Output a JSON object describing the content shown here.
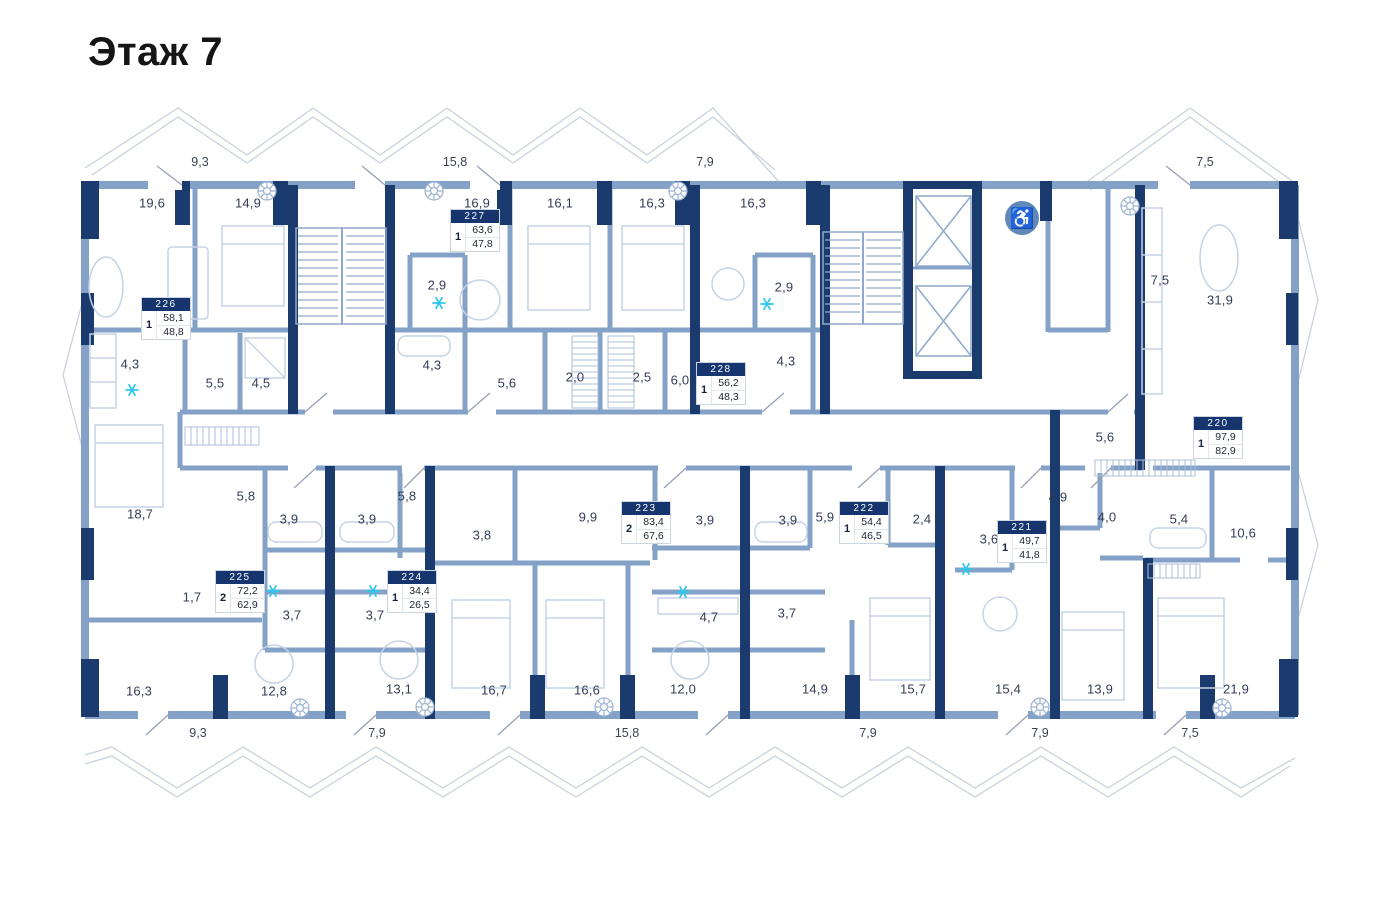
{
  "title": "Этаж 7",
  "colors": {
    "wall_dark": "#1b3a6e",
    "wall_light": "#84a1c7",
    "furniture": "#c5d3e5",
    "accent_snowflake": "#2ec6ea",
    "accessibility_bg": "#6089ba",
    "apartment_header_bg": "#16356e",
    "label_text": "#333d55"
  },
  "icons": {
    "accessibility_glyph": "♿",
    "accessibility_name": "wheelchair-accessibility",
    "snowflake_name": "air-conditioner-snowflake",
    "rosette_name": "ventilation-rosette"
  },
  "floor_plan": {
    "apartments": [
      {
        "number": "226",
        "rooms": "1",
        "area_total": "58,1",
        "area_living": "48,8",
        "x": 142,
        "y": 298
      },
      {
        "number": "227",
        "rooms": "1",
        "area_total": "63,6",
        "area_living": "47,8",
        "x": 451,
        "y": 210
      },
      {
        "number": "228",
        "rooms": "1",
        "area_total": "56,2",
        "area_living": "48,3",
        "x": 697,
        "y": 363
      },
      {
        "number": "220",
        "rooms": "1",
        "area_total": "97,9",
        "area_living": "82,9",
        "x": 1194,
        "y": 417
      },
      {
        "number": "225",
        "rooms": "2",
        "area_total": "72,2",
        "area_living": "62,9",
        "x": 216,
        "y": 571
      },
      {
        "number": "224",
        "rooms": "1",
        "area_total": "34,4",
        "area_living": "26,5",
        "x": 388,
        "y": 571
      },
      {
        "number": "223",
        "rooms": "2",
        "area_total": "83,4",
        "area_living": "67,6",
        "x": 622,
        "y": 502
      },
      {
        "number": "222",
        "rooms": "1",
        "area_total": "54,4",
        "area_living": "46,5",
        "x": 840,
        "y": 502
      },
      {
        "number": "221",
        "rooms": "1",
        "area_total": "49,7",
        "area_living": "41,8",
        "x": 998,
        "y": 521
      }
    ],
    "room_labels": [
      {
        "text": "19,6",
        "x": 152,
        "y": 203
      },
      {
        "text": "14,9",
        "x": 248,
        "y": 203
      },
      {
        "text": "16,9",
        "x": 477,
        "y": 203
      },
      {
        "text": "16,1",
        "x": 560,
        "y": 203
      },
      {
        "text": "16,3",
        "x": 652,
        "y": 203
      },
      {
        "text": "16,3",
        "x": 753,
        "y": 203
      },
      {
        "text": "7,5",
        "x": 1160,
        "y": 280
      },
      {
        "text": "31,9",
        "x": 1220,
        "y": 300
      },
      {
        "text": "2,9",
        "x": 437,
        "y": 285
      },
      {
        "text": "2,9",
        "x": 784,
        "y": 287
      },
      {
        "text": "4,3",
        "x": 130,
        "y": 364
      },
      {
        "text": "5,5",
        "x": 215,
        "y": 383
      },
      {
        "text": "4,5",
        "x": 261,
        "y": 383
      },
      {
        "text": "4,3",
        "x": 432,
        "y": 365
      },
      {
        "text": "5,6",
        "x": 507,
        "y": 383
      },
      {
        "text": "2,0",
        "x": 575,
        "y": 377
      },
      {
        "text": "2,5",
        "x": 642,
        "y": 377
      },
      {
        "text": "6,0",
        "x": 680,
        "y": 380
      },
      {
        "text": "4,3",
        "x": 786,
        "y": 361
      },
      {
        "text": "5,6",
        "x": 1105,
        "y": 437
      },
      {
        "text": "18,7",
        "x": 140,
        "y": 514
      },
      {
        "text": "5,8",
        "x": 246,
        "y": 496
      },
      {
        "text": "3,9",
        "x": 289,
        "y": 519
      },
      {
        "text": "3,9",
        "x": 367,
        "y": 519
      },
      {
        "text": "5,8",
        "x": 407,
        "y": 496
      },
      {
        "text": "3,8",
        "x": 482,
        "y": 535
      },
      {
        "text": "9,9",
        "x": 588,
        "y": 517
      },
      {
        "text": "3,9",
        "x": 705,
        "y": 520
      },
      {
        "text": "3,9",
        "x": 788,
        "y": 520
      },
      {
        "text": "5,9",
        "x": 825,
        "y": 517
      },
      {
        "text": "2,4",
        "x": 922,
        "y": 519
      },
      {
        "text": "3,6",
        "x": 989,
        "y": 539
      },
      {
        "text": "4,9",
        "x": 1058,
        "y": 497
      },
      {
        "text": "4,0",
        "x": 1107,
        "y": 517
      },
      {
        "text": "5,4",
        "x": 1179,
        "y": 519
      },
      {
        "text": "10,6",
        "x": 1243,
        "y": 533
      },
      {
        "text": "1,7",
        "x": 192,
        "y": 597
      },
      {
        "text": "3,7",
        "x": 292,
        "y": 615
      },
      {
        "text": "3,7",
        "x": 375,
        "y": 615
      },
      {
        "text": "4,7",
        "x": 709,
        "y": 617
      },
      {
        "text": "3,7",
        "x": 787,
        "y": 613
      },
      {
        "text": "16,3",
        "x": 139,
        "y": 691
      },
      {
        "text": "12,8",
        "x": 274,
        "y": 691
      },
      {
        "text": "13,1",
        "x": 399,
        "y": 689
      },
      {
        "text": "16,7",
        "x": 494,
        "y": 690
      },
      {
        "text": "16,6",
        "x": 587,
        "y": 690
      },
      {
        "text": "12,0",
        "x": 683,
        "y": 689
      },
      {
        "text": "14,9",
        "x": 815,
        "y": 689
      },
      {
        "text": "15,7",
        "x": 913,
        "y": 689
      },
      {
        "text": "15,4",
        "x": 1008,
        "y": 689
      },
      {
        "text": "13,9",
        "x": 1100,
        "y": 689
      },
      {
        "text": "21,9",
        "x": 1236,
        "y": 689
      }
    ],
    "dimension_labels_top": [
      {
        "text": "9,3",
        "x": 200,
        "y": 162
      },
      {
        "text": "15,8",
        "x": 455,
        "y": 162
      },
      {
        "text": "7,9",
        "x": 705,
        "y": 162
      },
      {
        "text": "7,5",
        "x": 1205,
        "y": 162
      }
    ],
    "dimension_labels_bottom": [
      {
        "text": "9,3",
        "x": 198,
        "y": 733
      },
      {
        "text": "7,9",
        "x": 377,
        "y": 733
      },
      {
        "text": "15,8",
        "x": 627,
        "y": 733
      },
      {
        "text": "7,9",
        "x": 868,
        "y": 733
      },
      {
        "text": "7,9",
        "x": 1040,
        "y": 733
      },
      {
        "text": "7,5",
        "x": 1190,
        "y": 733
      }
    ],
    "snowflakes": [
      {
        "x": 132,
        "y": 390
      },
      {
        "x": 439,
        "y": 303
      },
      {
        "x": 767,
        "y": 304
      },
      {
        "x": 273,
        "y": 591
      },
      {
        "x": 373,
        "y": 591
      },
      {
        "x": 683,
        "y": 592
      },
      {
        "x": 966,
        "y": 569
      }
    ],
    "accessibility_icon": {
      "x": 1022,
      "y": 218
    }
  }
}
